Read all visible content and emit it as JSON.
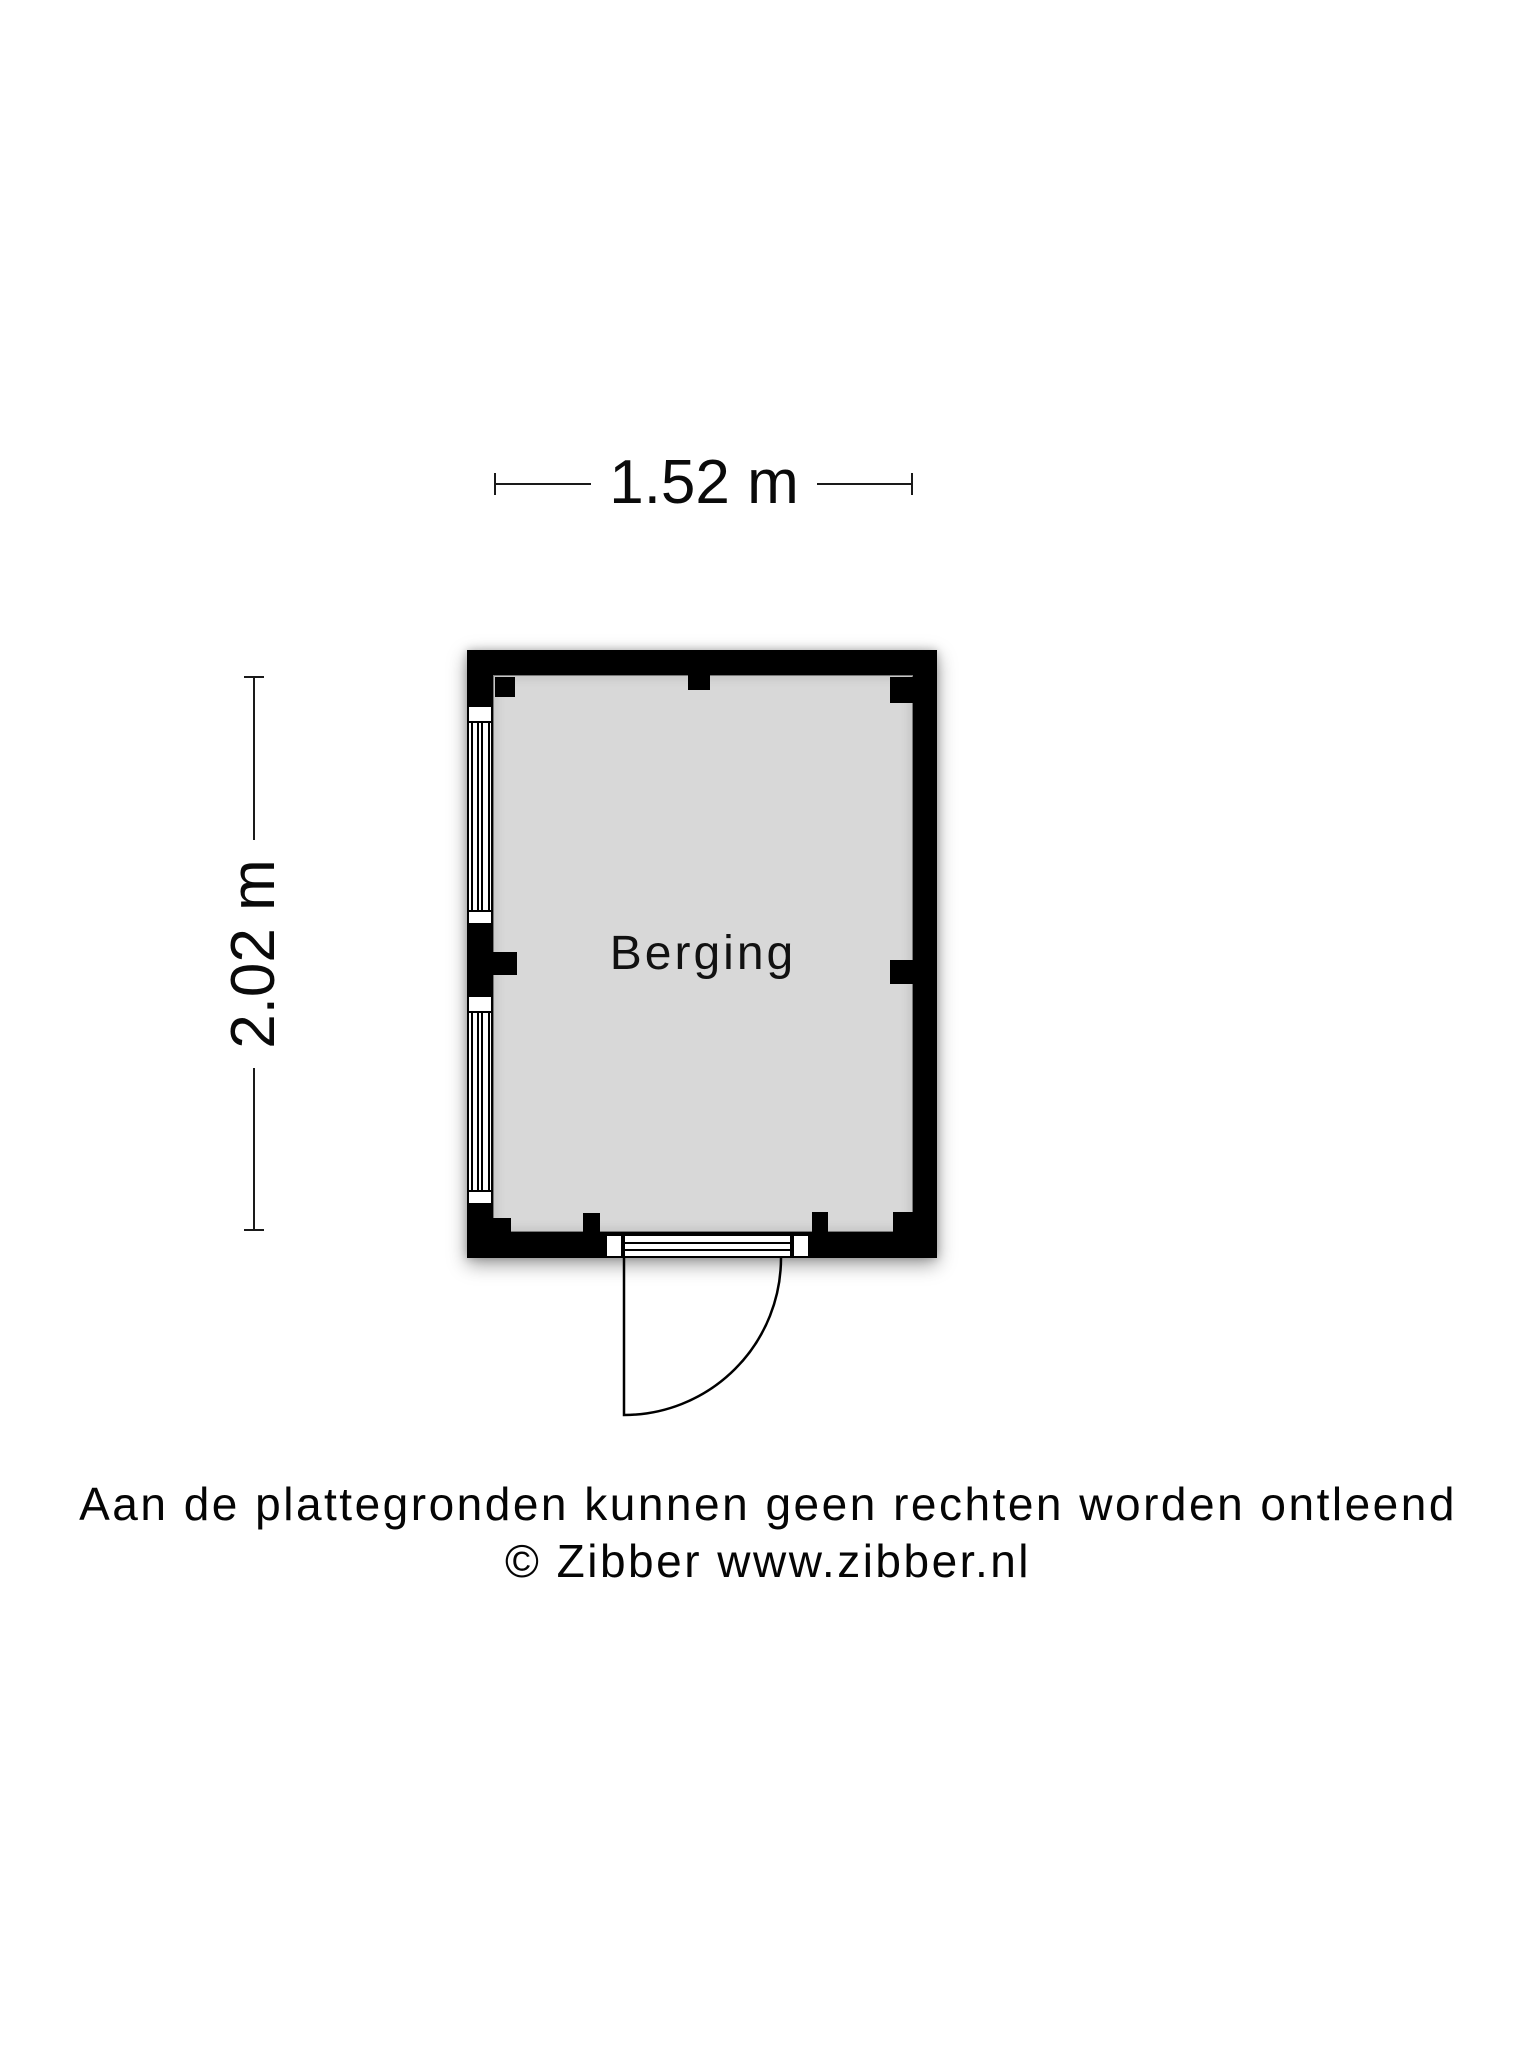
{
  "floorplan": {
    "room_label": "Berging",
    "dimensions": {
      "width_label": "1.52 m",
      "height_label": "2.02 m"
    },
    "colors": {
      "wall": "#000000",
      "floor": "#d8d8d8",
      "background": "#ffffff"
    }
  },
  "footer": {
    "disclaimer": "Aan de plattegronden kunnen geen rechten worden ontleend",
    "copyright": "© Zibber www.zibber.nl"
  }
}
